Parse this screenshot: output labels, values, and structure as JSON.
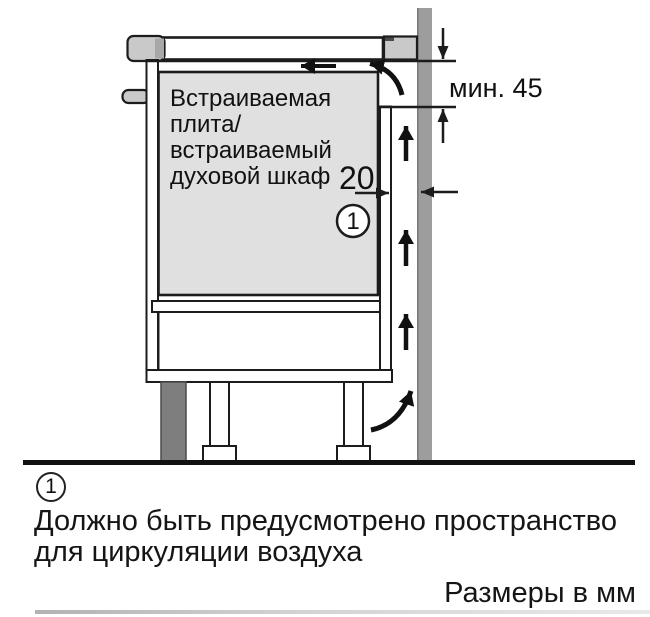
{
  "diagram": {
    "appliance_label": {
      "lines": [
        "Встраиваемая",
        "плита/",
        "встраиваемый",
        "духовой шкаф"
      ]
    },
    "dimensions": {
      "min_top_clearance": "мин. 45",
      "rear_vent_gap": "20"
    },
    "callout": {
      "number": "1"
    },
    "colors": {
      "wall": "#9D9D9D",
      "wall_edge": "#7A7A7A",
      "appliance_fill": "#E0E0E0",
      "trim": "#C9C9C9",
      "trim_dark": "#A8A8A8",
      "plinth": "#7E7E7E",
      "white": "#FFFFFF"
    }
  },
  "footnote": {
    "marker": "1",
    "line1": "Должно быть предусмотрено пространство",
    "line2": "для циркуляции воздуха"
  },
  "units_label": "Размеры в мм"
}
